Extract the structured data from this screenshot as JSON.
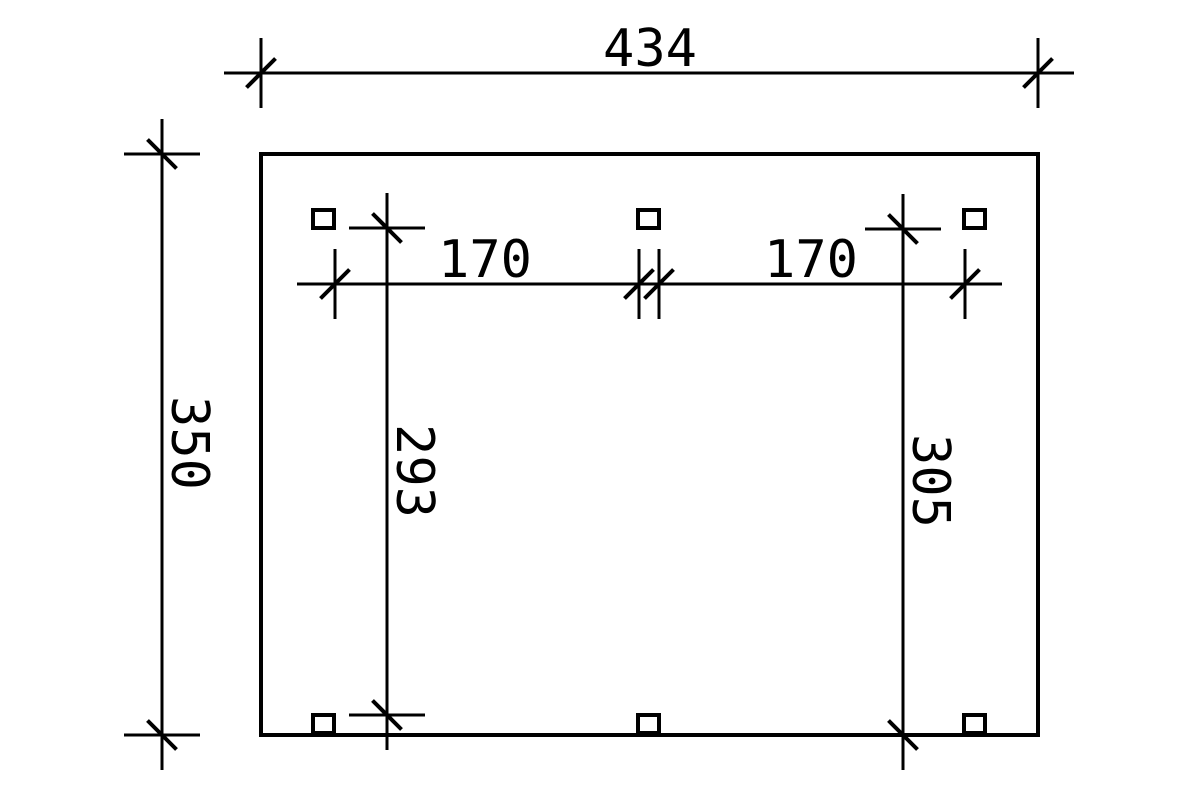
{
  "drawing": {
    "type": "technical-dimension-plan",
    "background_color": "#ffffff",
    "line_color": "#000000",
    "units_shown": false,
    "dimensions": {
      "overall_width": "434",
      "overall_height": "350",
      "bay_left": "170",
      "bay_right": "170",
      "clear_height_left": "293",
      "clear_height_right": "305"
    },
    "post_marker_count": 6
  }
}
